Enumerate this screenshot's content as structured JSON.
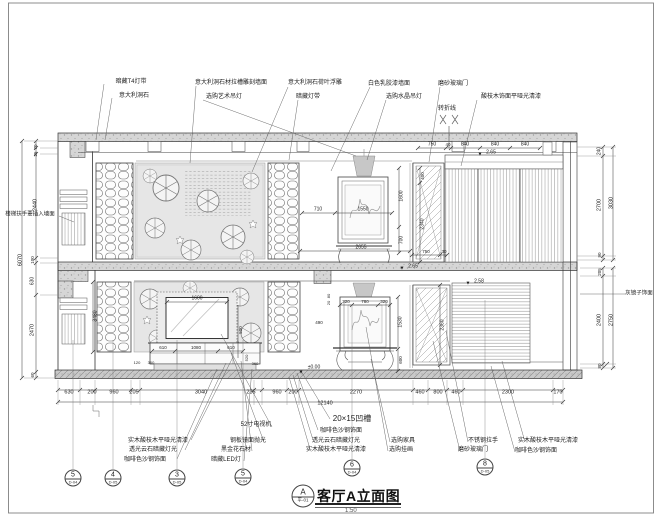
{
  "drawing": {
    "title": "客厅A立面图",
    "scale": "1:50",
    "ref_letter": "A",
    "ref_sheet": "平-01"
  },
  "colors": {
    "line": "#3a3a3a",
    "concrete_fill": "#d6d6d6",
    "mural_fill": "#e6e6e6",
    "lamp_fill": "#c7c7c7"
  },
  "detail_markers": [
    {
      "num": "5",
      "ref": "D-04",
      "x": 73,
      "y": 478
    },
    {
      "num": "4",
      "ref": "D-05",
      "x": 113,
      "y": 478
    },
    {
      "num": "3",
      "ref": "D-05",
      "x": 177,
      "y": 478
    },
    {
      "num": "5",
      "ref": "D-04",
      "x": 243,
      "y": 477
    },
    {
      "num": "6",
      "ref": "D-04",
      "x": 352,
      "y": 468
    },
    {
      "num": "8",
      "ref": "D-05",
      "x": 485,
      "y": 467
    }
  ],
  "labels": [
    {
      "t": "暗藏T4灯带",
      "x": 131,
      "y": 82,
      "n": "material-callout"
    },
    {
      "t": "意大利洞石",
      "x": 134,
      "y": 96,
      "n": "material-callout"
    },
    {
      "t": "意大利洞石材拉槽雕刻墙面",
      "x": 231,
      "y": 83,
      "n": "material-callout"
    },
    {
      "t": "选购艺术吊灯",
      "x": 224,
      "y": 97,
      "n": "material-callout"
    },
    {
      "t": "意大利洞石荷叶浮雕",
      "x": 315,
      "y": 83,
      "n": "material-callout"
    },
    {
      "t": "暗藏灯带",
      "x": 308,
      "y": 97,
      "n": "material-callout"
    },
    {
      "t": "白色乳胶漆墙面",
      "x": 389,
      "y": 84,
      "n": "material-callout"
    },
    {
      "t": "选购水晶吊灯",
      "x": 404,
      "y": 97,
      "n": "material-callout"
    },
    {
      "t": "磨砂玻璃门",
      "x": 453,
      "y": 84,
      "n": "material-callout"
    },
    {
      "t": "酸枝木饰面平哑光清漆",
      "x": 511,
      "y": 97,
      "n": "material-callout"
    },
    {
      "t": "转折线",
      "x": 447,
      "y": 109,
      "n": "fold-line-label"
    },
    {
      "t": "实木酸枝木平哑光清漆",
      "x": 158,
      "y": 441,
      "n": "material-callout"
    },
    {
      "t": "透光云石暗藏灯光",
      "x": 153,
      "y": 450,
      "n": "material-callout"
    },
    {
      "t": "咖啡色沙钢饰面",
      "x": 145,
      "y": 460,
      "n": "material-callout"
    },
    {
      "t": "52寸电视机",
      "x": 256,
      "y": 425,
      "n": "material-callout"
    },
    {
      "t": "钢板镜面抛光",
      "x": 248,
      "y": 441,
      "n": "material-callout"
    },
    {
      "t": "黑金花石材",
      "x": 236,
      "y": 450,
      "n": "material-callout"
    },
    {
      "t": "暗藏LED灯",
      "x": 226,
      "y": 460,
      "n": "material-callout"
    },
    {
      "t": "20×15凹槽",
      "x": 352,
      "y": 419,
      "s": 8,
      "n": "groove-note"
    },
    {
      "t": "咖啡色沙钢饰面",
      "x": 341,
      "y": 431,
      "n": "material-callout"
    },
    {
      "t": "透光云石暗藏灯光",
      "x": 336,
      "y": 441,
      "n": "material-callout"
    },
    {
      "t": "实木酸枝木平哑光清漆",
      "x": 336,
      "y": 450,
      "n": "material-callout"
    },
    {
      "t": "选购家具",
      "x": 403,
      "y": 441,
      "n": "material-callout"
    },
    {
      "t": "选购挂画",
      "x": 401,
      "y": 450,
      "n": "material-callout"
    },
    {
      "t": "不锈钢拉手",
      "x": 483,
      "y": 441,
      "n": "material-callout"
    },
    {
      "t": "磨砂玻璃门",
      "x": 473,
      "y": 450,
      "n": "material-callout"
    },
    {
      "t": "实木酸枝木平哑光清漆",
      "x": 548,
      "y": 441,
      "n": "material-callout"
    },
    {
      "t": "咖啡色沙钢饰面",
      "x": 536,
      "y": 451,
      "n": "material-callout"
    },
    {
      "t": "楼梯扶手要插入墙面",
      "x": 30,
      "y": 215,
      "s": 5.5,
      "n": "stair-note"
    },
    {
      "t": "灰镜子饰面",
      "x": 639,
      "y": 294,
      "s": 5.5,
      "n": "material-callout"
    },
    {
      "t": "630",
      "x": 69,
      "y": 393,
      "s": 5.5
    },
    {
      "t": "200",
      "x": 92,
      "y": 393,
      "s": 5.5
    },
    {
      "t": "960",
      "x": 114,
      "y": 393,
      "s": 5.5
    },
    {
      "t": "205",
      "x": 134,
      "y": 393,
      "s": 5.5
    },
    {
      "t": "3040",
      "x": 201,
      "y": 393,
      "s": 5.5
    },
    {
      "t": "235",
      "x": 251,
      "y": 393,
      "s": 5.5
    },
    {
      "t": "960",
      "x": 277,
      "y": 393,
      "s": 5.5
    },
    {
      "t": "200",
      "x": 293,
      "y": 393,
      "s": 5.5
    },
    {
      "t": "2270",
      "x": 356,
      "y": 393,
      "s": 5.5
    },
    {
      "t": "460",
      "x": 420,
      "y": 393,
      "s": 5.5
    },
    {
      "t": "800",
      "x": 438,
      "y": 393,
      "s": 5.5
    },
    {
      "t": "460",
      "x": 456,
      "y": 393,
      "s": 5.5
    },
    {
      "t": "2300",
      "x": 508,
      "y": 393,
      "s": 5.5
    },
    {
      "t": "170",
      "x": 558,
      "y": 393,
      "s": 5.5
    },
    {
      "t": "12140",
      "x": 325,
      "y": 404,
      "s": 5.5
    },
    {
      "t": "70",
      "x": 36,
      "y": 147,
      "s": 4.5,
      "r": 1
    },
    {
      "t": "25",
      "x": 36,
      "y": 154,
      "s": 4.5,
      "r": 1
    },
    {
      "t": "2440",
      "x": 36,
      "y": 205,
      "s": 5.5,
      "r": 1
    },
    {
      "t": "100",
      "x": 33,
      "y": 260,
      "s": 4.5,
      "r": 1
    },
    {
      "t": "630",
      "x": 33,
      "y": 281,
      "s": 5,
      "r": 1
    },
    {
      "t": "2470",
      "x": 33,
      "y": 330,
      "s": 5.5,
      "r": 1
    },
    {
      "t": "60",
      "x": 33,
      "y": 375,
      "s": 4.5,
      "r": 1
    },
    {
      "t": "6070",
      "x": 21,
      "y": 260,
      "s": 5.5,
      "r": 1
    },
    {
      "t": "240",
      "x": 600,
      "y": 151,
      "s": 5,
      "r": 1
    },
    {
      "t": "2700",
      "x": 600,
      "y": 205,
      "s": 5.5,
      "r": 1
    },
    {
      "t": "90",
      "x": 600,
      "y": 255,
      "s": 4.5,
      "r": 1
    },
    {
      "t": "3030",
      "x": 612,
      "y": 203,
      "s": 5.5,
      "r": 1
    },
    {
      "t": "205",
      "x": 600,
      "y": 272,
      "s": 4.5,
      "r": 1
    },
    {
      "t": "2400",
      "x": 600,
      "y": 320,
      "s": 5.5,
      "r": 1
    },
    {
      "t": "80",
      "x": 600,
      "y": 366,
      "s": 4.5,
      "r": 1
    },
    {
      "t": "2750",
      "x": 612,
      "y": 320,
      "s": 5.5,
      "r": 1
    },
    {
      "t": "750",
      "x": 432,
      "y": 145,
      "s": 5
    },
    {
      "t": "40",
      "x": 448,
      "y": 145,
      "s": 4.5
    },
    {
      "t": "840",
      "x": 465,
      "y": 145,
      "s": 5
    },
    {
      "t": "840",
      "x": 495,
      "y": 145,
      "s": 5
    },
    {
      "t": "840",
      "x": 525,
      "y": 145,
      "s": 5
    },
    {
      "t": "710",
      "x": 318,
      "y": 210,
      "s": 5
    },
    {
      "t": "1550",
      "x": 363,
      "y": 210,
      "s": 5
    },
    {
      "t": "1600",
      "x": 402,
      "y": 196,
      "s": 5,
      "r": 1
    },
    {
      "t": "700",
      "x": 402,
      "y": 240,
      "s": 5,
      "r": 1
    },
    {
      "t": "2655",
      "x": 361,
      "y": 248,
      "s": 5
    },
    {
      "t": "400",
      "x": 423,
      "y": 176,
      "s": 4.5,
      "r": 1
    },
    {
      "t": "2340",
      "x": 423,
      "y": 224,
      "s": 5,
      "r": 1
    },
    {
      "t": "750",
      "x": 426,
      "y": 252,
      "s": 4.5
    },
    {
      "t": "30",
      "x": 444,
      "y": 252,
      "s": 4.5
    },
    {
      "t": "1600",
      "x": 197,
      "y": 299,
      "s": 5
    },
    {
      "t": "610",
      "x": 163,
      "y": 348,
      "s": 4.5
    },
    {
      "t": "1080",
      "x": 196,
      "y": 348,
      "s": 4.5
    },
    {
      "t": "610",
      "x": 231,
      "y": 348,
      "s": 4.5
    },
    {
      "t": "500",
      "x": 241,
      "y": 330,
      "s": 4.5,
      "r": 1
    },
    {
      "t": "3480",
      "x": 96,
      "y": 316,
      "s": 5,
      "r": 1
    },
    {
      "t": "120",
      "x": 137,
      "y": 363,
      "s": 4
    },
    {
      "t": "360",
      "x": 151,
      "y": 363,
      "s": 4
    },
    {
      "t": "520",
      "x": 247,
      "y": 358,
      "s": 4,
      "r": 1
    },
    {
      "t": "360",
      "x": 255,
      "y": 364,
      "s": 4
    },
    {
      "t": "320",
      "x": 346,
      "y": 302,
      "s": 4.5
    },
    {
      "t": "780",
      "x": 365,
      "y": 302,
      "s": 4.5
    },
    {
      "t": "320",
      "x": 384,
      "y": 302,
      "s": 4.5
    },
    {
      "t": "80",
      "x": 329,
      "y": 296,
      "s": 4,
      "r": 1
    },
    {
      "t": "20",
      "x": 329,
      "y": 303,
      "s": 4,
      "r": 1
    },
    {
      "t": "490",
      "x": 319,
      "y": 323,
      "s": 4.5
    },
    {
      "t": "1530",
      "x": 401,
      "y": 322,
      "s": 5,
      "r": 1
    },
    {
      "t": "600",
      "x": 401,
      "y": 360,
      "s": 4.5,
      "r": 1
    },
    {
      "t": "2360",
      "x": 443,
      "y": 325,
      "s": 5,
      "r": 1
    },
    {
      "t": "▼",
      "x": 480,
      "y": 155,
      "s": 5,
      "n": "elevation-marker"
    },
    {
      "t": "2.65",
      "x": 491,
      "y": 153,
      "s": 5,
      "n": "elevation-value"
    },
    {
      "t": "▼",
      "x": 402,
      "y": 269,
      "s": 5,
      "n": "elevation-marker"
    },
    {
      "t": "2.65",
      "x": 413,
      "y": 267,
      "s": 5,
      "n": "elevation-value"
    },
    {
      "t": "▼",
      "x": 468,
      "y": 284,
      "s": 5,
      "n": "elevation-marker"
    },
    {
      "t": "2.58",
      "x": 479,
      "y": 282,
      "s": 5,
      "n": "elevation-value"
    },
    {
      "t": "▼",
      "x": 301,
      "y": 373,
      "s": 5,
      "n": "elevation-marker"
    },
    {
      "t": "±0.00",
      "x": 314,
      "y": 368,
      "s": 5,
      "n": "elevation-value"
    }
  ]
}
